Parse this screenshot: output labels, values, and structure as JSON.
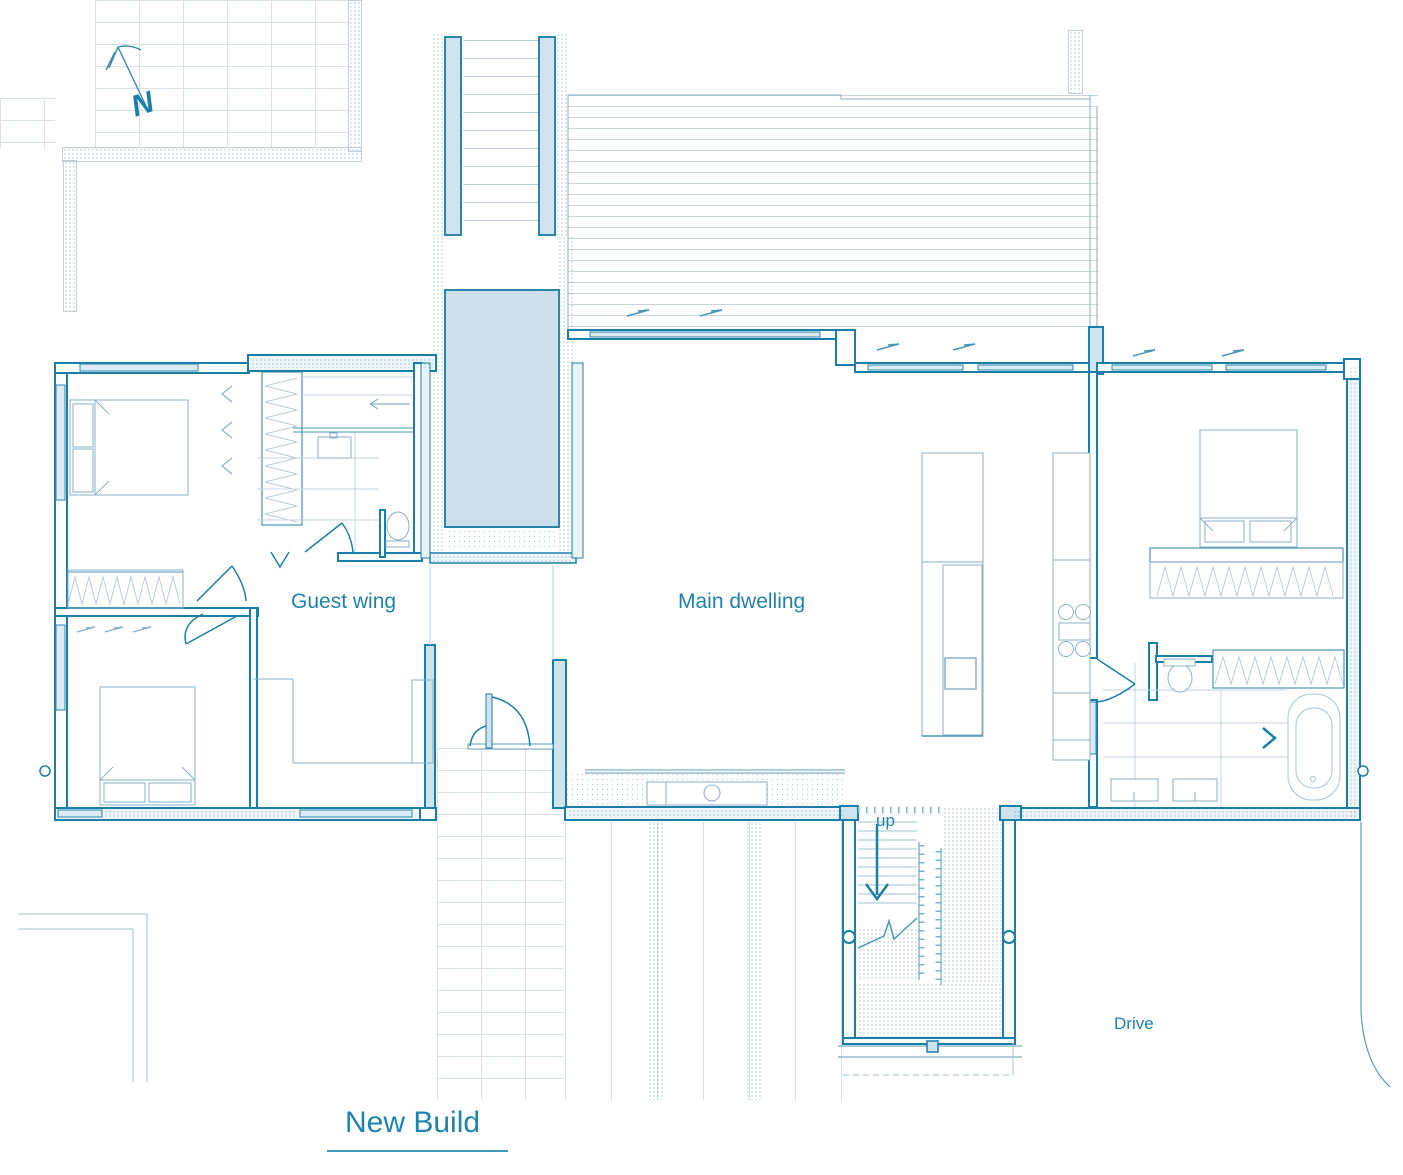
{
  "page": {
    "background": "#ffffff",
    "type": "architectural-floor-plan"
  },
  "title": {
    "text": "New Build"
  },
  "labels": {
    "north": "N",
    "guest_wing": "Guest wing",
    "main_dwelling": "Main dwelling",
    "stairs_up": "up",
    "drive": "Drive"
  },
  "colors": {
    "line_teal": "#1a7fa8",
    "wall_fill_light_blue": "#cfe3ef",
    "pool_fill": "#cddfeb",
    "label_text": "#1f82ab"
  },
  "plan_elements": [
    "north-arrow",
    "existing-garden-wall",
    "brick-paving",
    "timber-deck",
    "swimming-pool",
    "guest-wing-bedrooms",
    "guest-bathroom",
    "entry-link",
    "main-dwelling-open-plan",
    "kitchen-island",
    "kitchen-wall-counter",
    "master-bedroom",
    "wardrobes",
    "en-suite-bathroom",
    "bath",
    "staircase-up",
    "drive",
    "site-boundary-tree-line"
  ]
}
